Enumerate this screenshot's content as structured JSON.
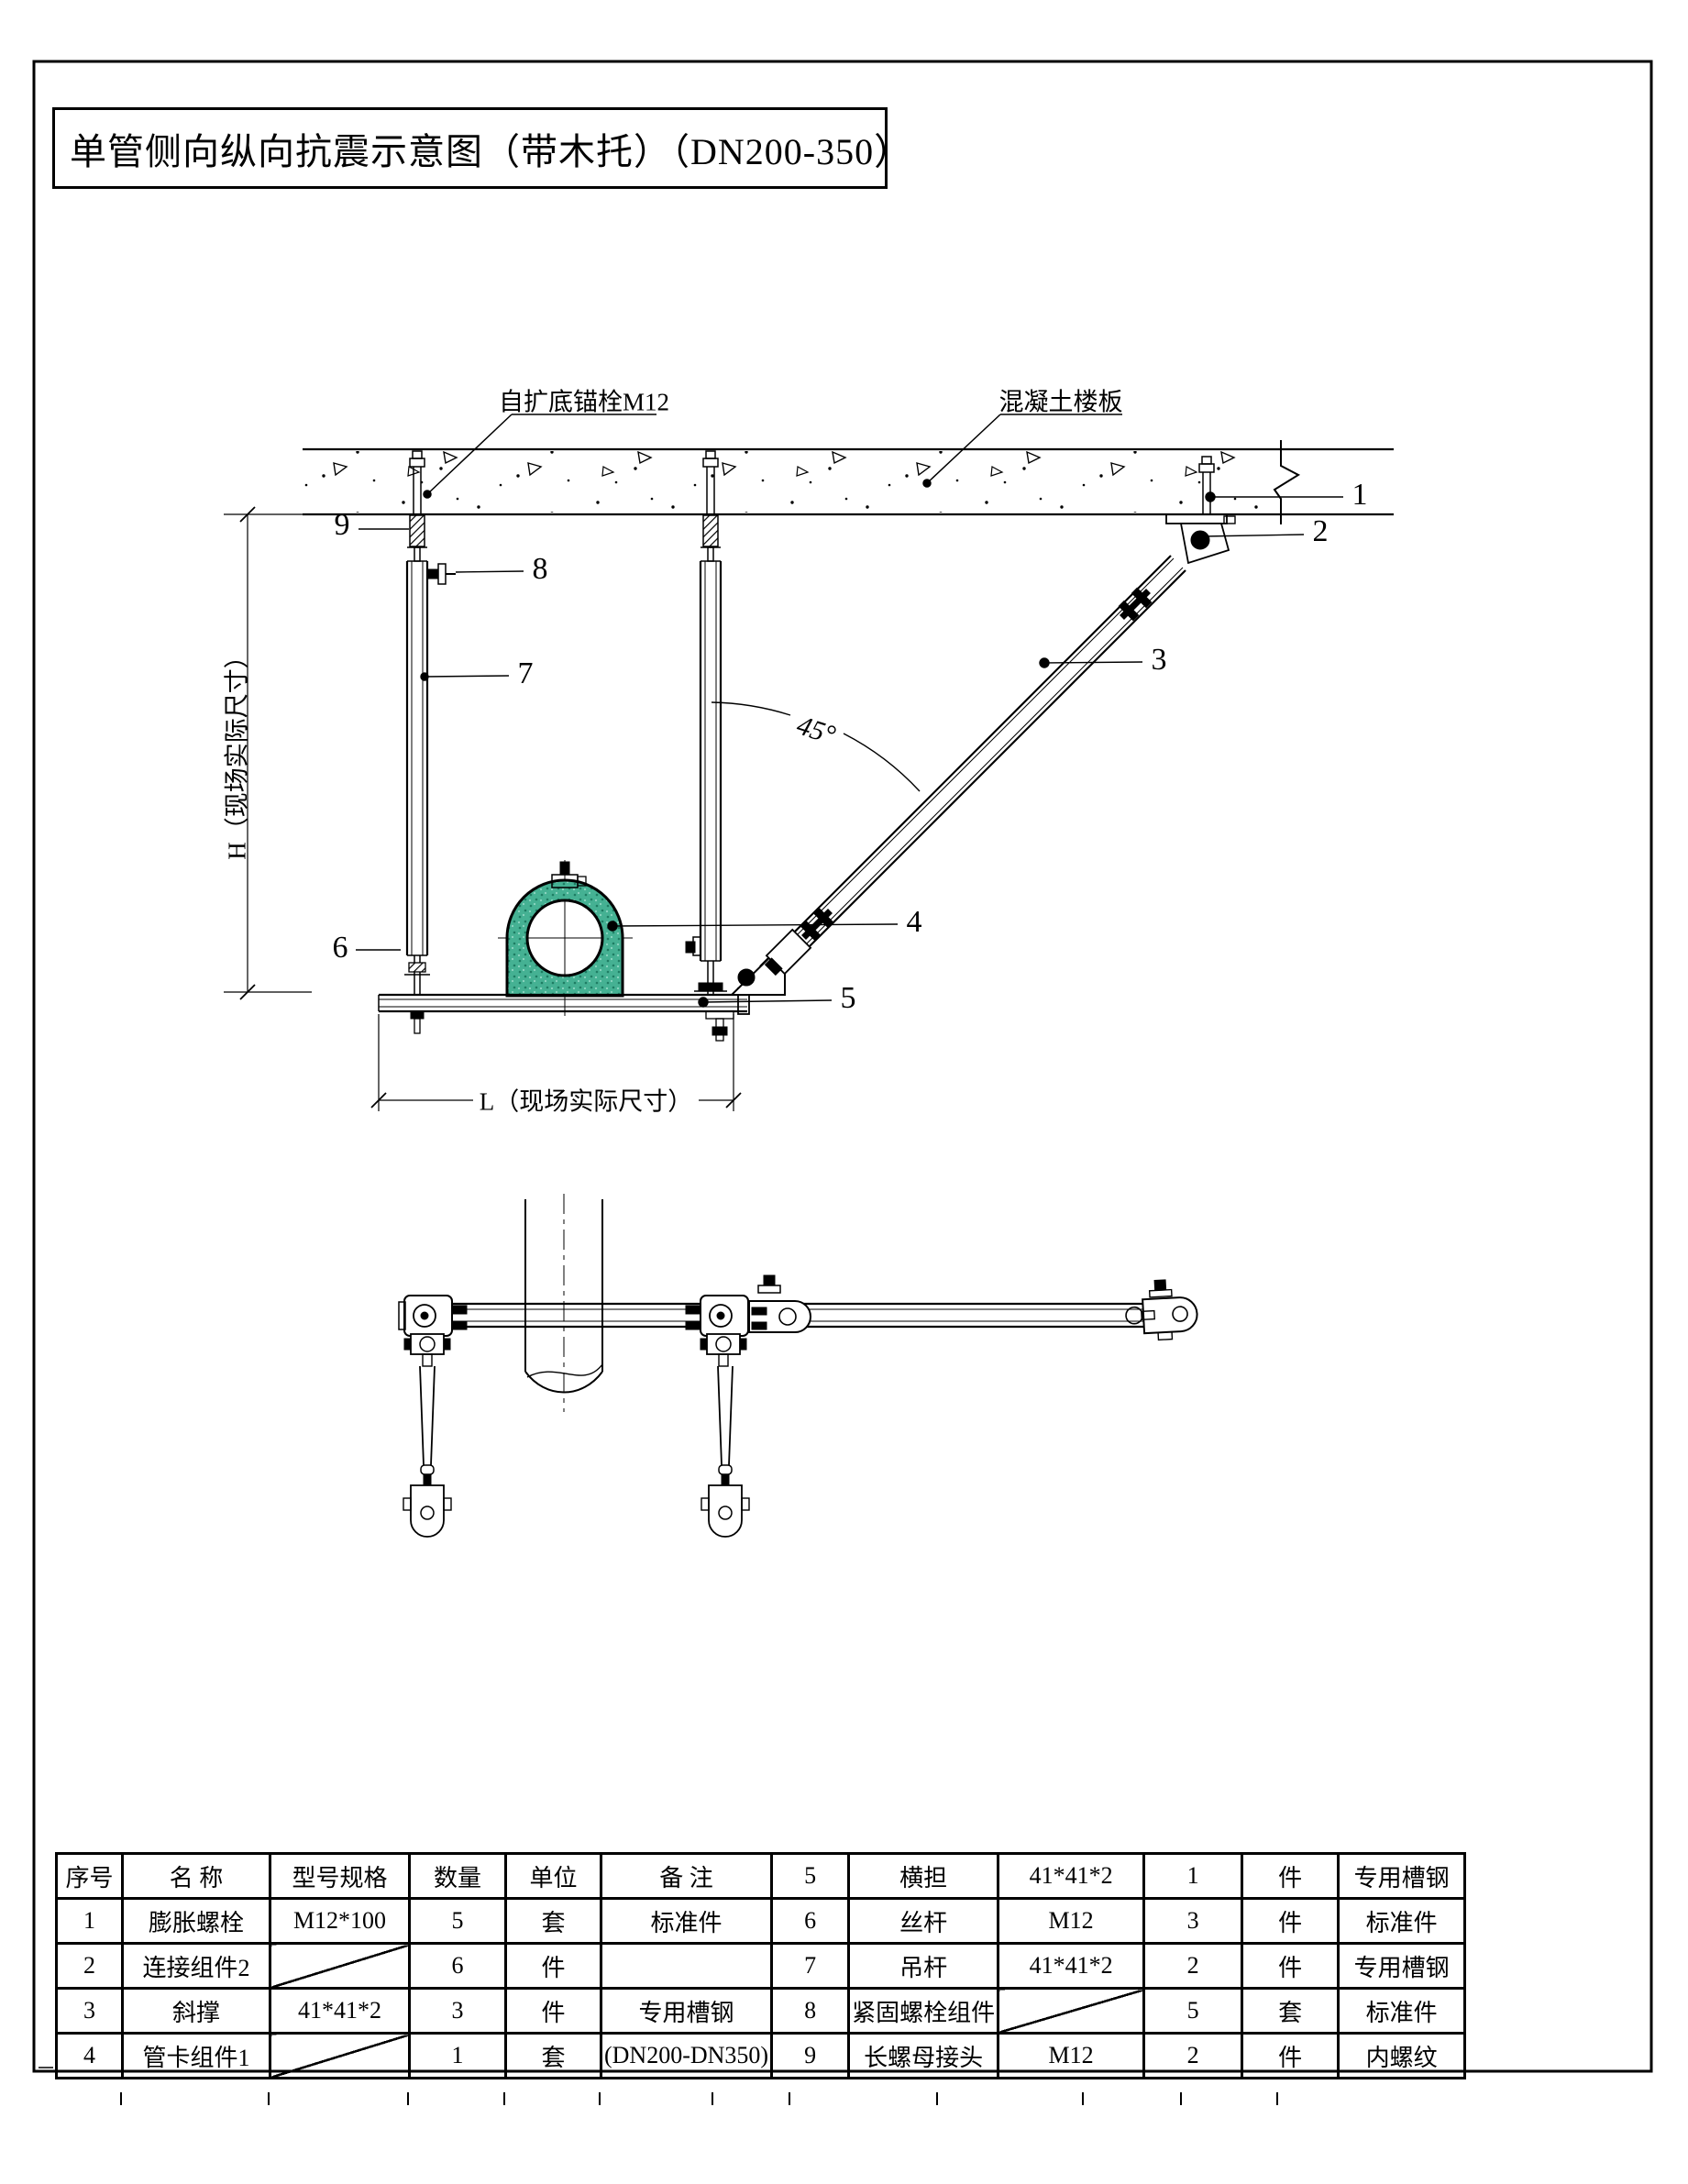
{
  "title": "单管侧向纵向抗震示意图（带木托）（DN200-350）",
  "labels": {
    "anchor_bolt": "自扩底锚栓M12",
    "concrete_slab": "混凝土楼板",
    "dim_h": "H（现场实际尺寸）",
    "dim_l": "L（现场实际尺寸）",
    "angle": "45°"
  },
  "callouts": {
    "c1": "1",
    "c2": "2",
    "c3": "3",
    "c4": "4",
    "c5": "5",
    "c6": "6",
    "c7": "7",
    "c8": "8",
    "c9": "9"
  },
  "colors": {
    "wood_block_green": "#45b193",
    "line": "#000000",
    "paper": "#ffffff"
  },
  "table": {
    "headers": {
      "no": "序号",
      "name": "名 称",
      "spec": "型号规格",
      "qty": "数量",
      "unit": "单位",
      "note": "备 注"
    },
    "rows_left": [
      {
        "no": "1",
        "name": "膨胀螺栓",
        "spec": "M12*100",
        "qty": "5",
        "unit": "套",
        "note": "标准件"
      },
      {
        "no": "2",
        "name": "连接组件2",
        "spec": "",
        "qty": "6",
        "unit": "件",
        "note": ""
      },
      {
        "no": "3",
        "name": "斜撑",
        "spec": "41*41*2",
        "qty": "3",
        "unit": "件",
        "note": "专用槽钢"
      },
      {
        "no": "4",
        "name": "管卡组件1",
        "spec": "",
        "qty": "1",
        "unit": "套",
        "note": "(DN200-DN350)"
      }
    ],
    "rows_right": [
      {
        "no": "5",
        "name": "横担",
        "spec": "41*41*2",
        "qty": "1",
        "unit": "件",
        "note": "专用槽钢"
      },
      {
        "no": "6",
        "name": "丝杆",
        "spec": "M12",
        "qty": "3",
        "unit": "件",
        "note": "标准件"
      },
      {
        "no": "7",
        "name": "吊杆",
        "spec": "41*41*2",
        "qty": "2",
        "unit": "件",
        "note": "专用槽钢"
      },
      {
        "no": "8",
        "name": "紧固螺栓组件",
        "spec": "",
        "qty": "5",
        "unit": "套",
        "note": "标准件"
      },
      {
        "no": "9",
        "name": "长螺母接头",
        "spec": "M12",
        "qty": "2",
        "unit": "件",
        "note": "内螺纹"
      }
    ]
  }
}
